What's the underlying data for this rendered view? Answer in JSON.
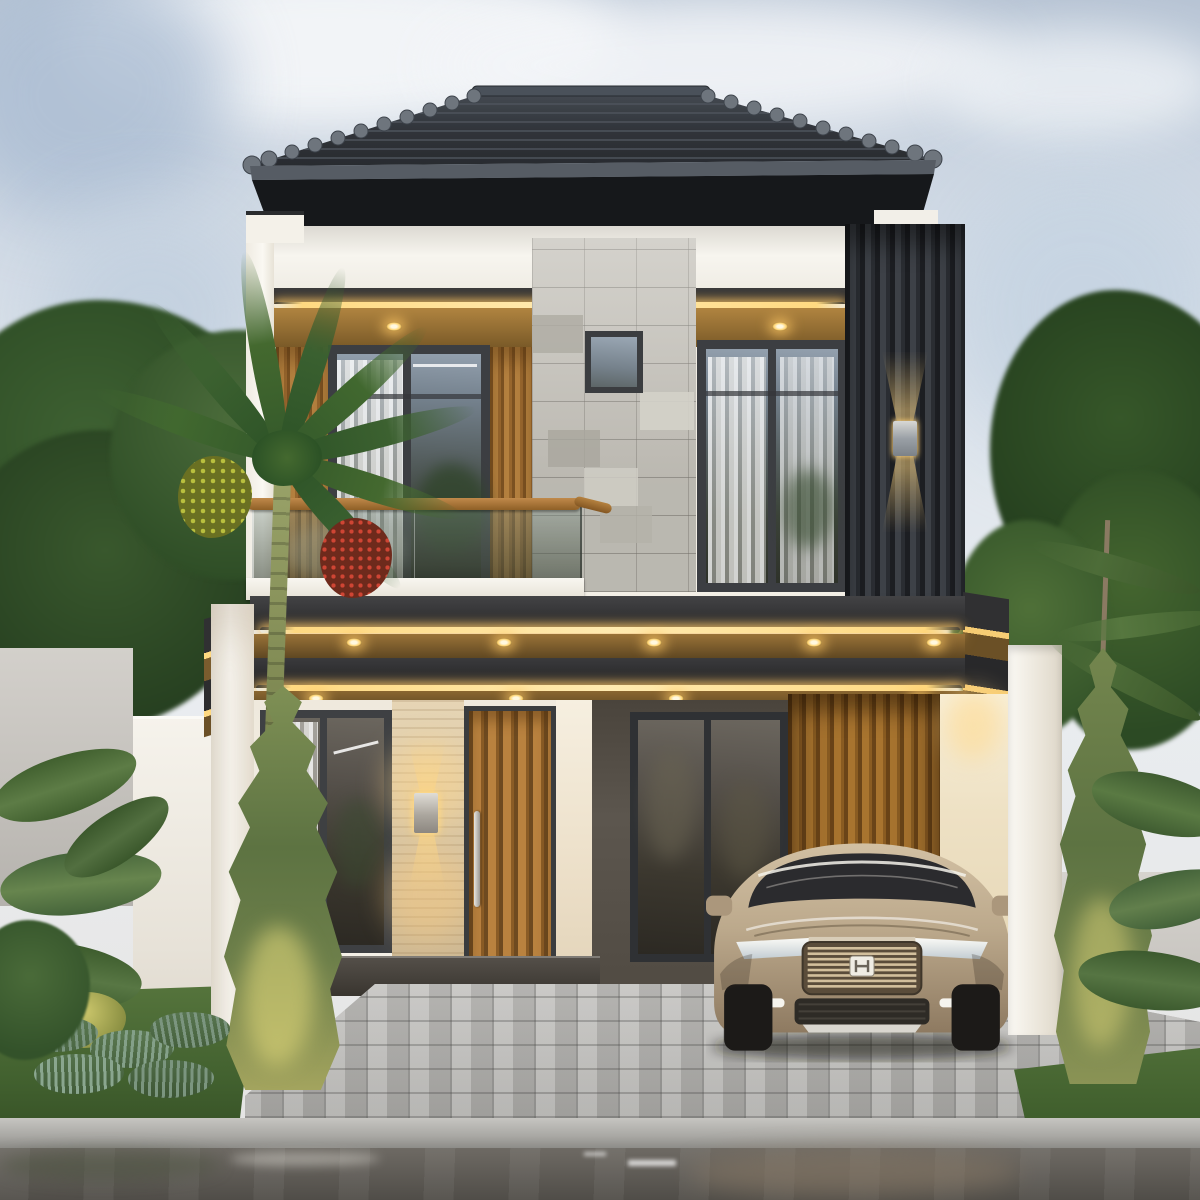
{
  "scene": {
    "type": "architectural-exterior-3d-render",
    "subject": "modern two-story tropical minimalist house at dusk with warm LED accent lighting",
    "sky": "pale overcast blue with soft white clouds",
    "house": {
      "roof": "dark charcoal hip roof with barrel ridge caps and deep eaves",
      "facade_materials": [
        "warm white painted walls",
        "gray stone tile accent wall",
        "teak wood slat panels",
        "dark vertical louver screen",
        "travertine entry wall",
        "dark textured plaster wall"
      ],
      "lighting": [
        "warm LED strip coves along canopy edges",
        "recessed soffit downlights in wood ceilings",
        "up-down wall sconce on louver screen",
        "up-down sconce on travertine entry wall"
      ],
      "second_floor": [
        "balcony with frameless glass railing and wood handrail",
        "large dark-framed window with sheer curtains (left)",
        "large dark-framed window with sheer curtains (right)",
        "small square window in stone wall"
      ],
      "first_floor": [
        "entry door with vertical wood slats and long steel pull handle",
        "dark-framed window left of entry",
        "dark-framed window in carport wall",
        "carport with wood slat back wall"
      ]
    },
    "vehicle": "champagne-beige compact SUV with chrome-bar grille parked in carport",
    "landscape": [
      "palm tree with red and yellow-green berry clusters",
      "tall cypress conifers left and right",
      "banana plants and tropical shrubs",
      "feathery fern bed on lawn",
      "street trees behind boundary walls"
    ],
    "ground": [
      "gray interlocking paver driveway",
      "light concrete curb",
      "wet asphalt road with reflections"
    ],
    "boundary": [
      "light gray perimeter walls",
      "white garden walls and pillars"
    ]
  },
  "palette": {
    "sky_top": "#b7c4d4",
    "sky_mid": "#dde4ec",
    "cloud": "#f4f6f8",
    "roof_tile": "#262a30",
    "ridge_cap": "#6e757d",
    "fascia_dark": "#17191c",
    "wall_white": "#f3efe6",
    "stone_gray": "#c3c0b8",
    "wood_teak": "#a9783c",
    "wood_soffit": "#8a6a36",
    "louver_dark": "#33363b",
    "glass_reflection": "#55606a",
    "led_warm": "#ffd87e",
    "travertine": "#d9c6a6",
    "dark_wall": "#57514a",
    "door_wood": "#b5813f",
    "car_champagne": "#bfab8e",
    "grass": "#4a6634",
    "foliage": "#3a5c2e",
    "paver": "#b5b4b1",
    "curb": "#a3a29e",
    "road_wet": "#5e5a55"
  }
}
